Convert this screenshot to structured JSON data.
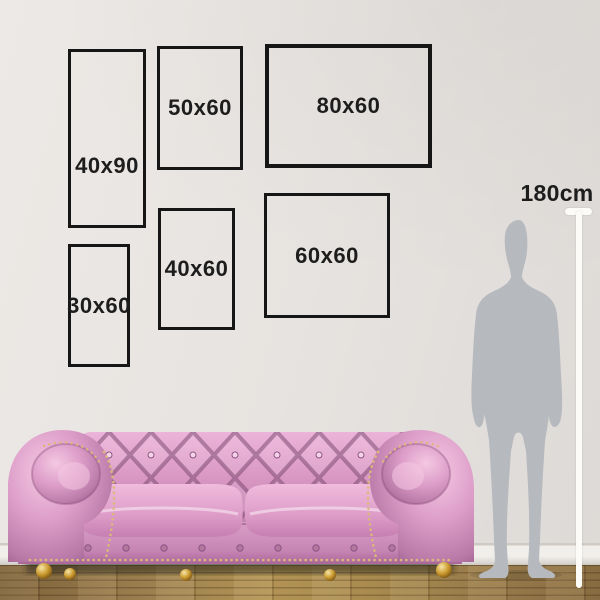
{
  "frames": [
    {
      "label": "40x90",
      "width_cm": 40,
      "height_cm": 90
    },
    {
      "label": "50x60",
      "width_cm": 50,
      "height_cm": 60
    },
    {
      "label": "80x60",
      "width_cm": 80,
      "height_cm": 60
    },
    {
      "label": "30x60",
      "width_cm": 30,
      "height_cm": 60
    },
    {
      "label": "40x60",
      "width_cm": 40,
      "height_cm": 60
    },
    {
      "label": "60x60",
      "width_cm": 60,
      "height_cm": 60
    }
  ],
  "height_reference": {
    "label": "180cm"
  },
  "illustrations": {
    "person": "standing-man-silhouette",
    "furniture": "pink-chesterfield-sofa",
    "ruler": "white-height-measure-line"
  },
  "colors": {
    "frame_border": "#161616",
    "label_text": "#1d1d1d",
    "wall": "#e7e3e0",
    "baseboard": "#f1efeb",
    "floor_wood": "#a98a4f",
    "ruler": "#fcfbf8",
    "silhouette": "#b6b9be",
    "sofa_pink": "#d795c1",
    "sofa_highlight": "#f2c6e0",
    "sofa_shadow": "#96588a",
    "stud_gold": "#dcb979"
  }
}
